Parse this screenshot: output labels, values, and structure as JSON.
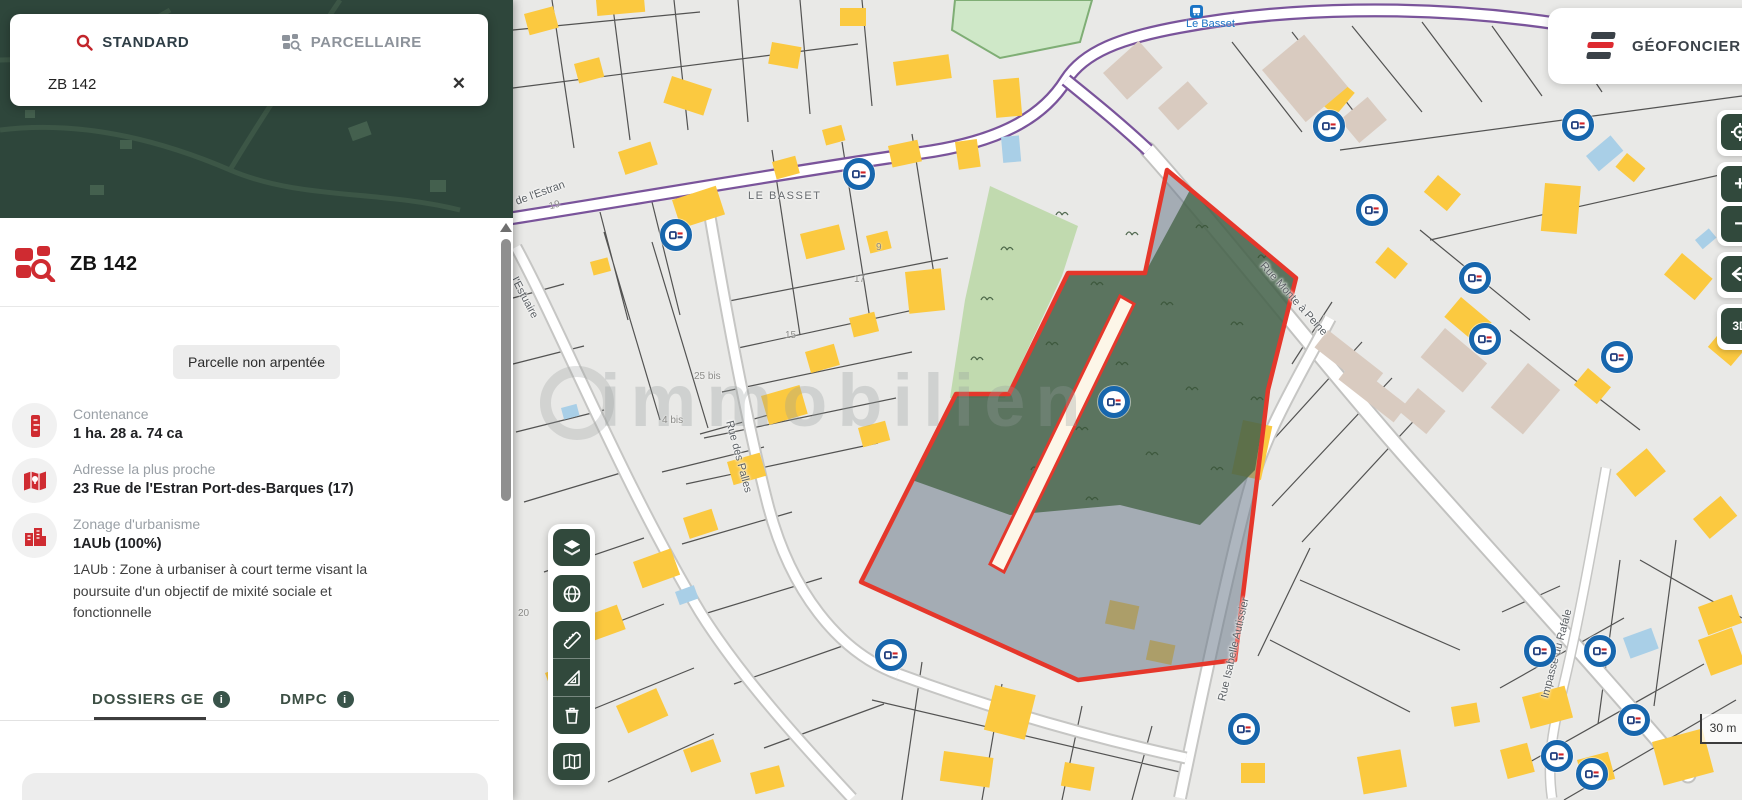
{
  "sidebar": {
    "search": {
      "tabs": [
        {
          "label": "STANDARD",
          "icon": "search-icon",
          "active": true
        },
        {
          "label": "PARCELLAIRE",
          "icon": "parcel-search-icon",
          "active": false
        }
      ],
      "value": "ZB 142",
      "clear": "✕"
    },
    "parcel": {
      "id": "ZB 142",
      "badge": "Parcelle non arpentée",
      "fields": [
        {
          "icon": "ruler-icon",
          "label": "Contenance",
          "value": "1 ha. 28 a. 74 ca"
        },
        {
          "icon": "map-pin-icon",
          "label": "Adresse la plus proche",
          "value": "23 Rue de l'Estran Port-des-Barques (17)"
        },
        {
          "icon": "buildings-icon",
          "label": "Zonage d'urbanisme",
          "value": "1AUb (100%)",
          "description": "1AUb : Zone à urbaniser à court terme visant la poursuite d'un objectif de mixité sociale et fonctionnelle"
        }
      ],
      "tabs": [
        {
          "label": "DOSSIERS GE",
          "info": "i",
          "active": true
        },
        {
          "label": "DMPC",
          "info": "i",
          "active": false
        }
      ]
    }
  },
  "map": {
    "brand": "GÉOFONCIER",
    "scale_label": "30 m",
    "watermark": "immobilien",
    "place_label": "LE BASSET",
    "bus_stop": "Le Basset",
    "streets": [
      "de l'Estran",
      "Rue des Palles",
      "Rue Monte à Peine",
      "Rue Isabelle Autissier",
      "Impasse du Rafale",
      "l'Estuaire"
    ],
    "parcel_numbers": [
      "19",
      "9",
      "17",
      "15",
      "25 bis",
      "4 bis",
      "20"
    ],
    "markers": [
      [
        859,
        174
      ],
      [
        676,
        235
      ],
      [
        1329,
        126
      ],
      [
        1372,
        210
      ],
      [
        1578,
        125
      ],
      [
        1475,
        278
      ],
      [
        1485,
        339
      ],
      [
        1617,
        357
      ],
      [
        1114,
        402
      ],
      [
        891,
        655
      ],
      [
        1244,
        729
      ],
      [
        1540,
        651
      ],
      [
        1600,
        651
      ],
      [
        1634,
        720
      ],
      [
        1557,
        756
      ],
      [
        1592,
        774
      ]
    ],
    "tools": [
      "layers-icon",
      "globe-icon",
      "ruler-icon",
      "set-square-icon",
      "trash-icon",
      "map-book-icon"
    ],
    "zoom_controls": [
      "locate",
      "zoom-in",
      "zoom-out",
      "back",
      "3d"
    ],
    "colors": {
      "selection_red": "#e5372b",
      "woodland_green": "#54724f",
      "zone_gray": "#76839a",
      "building_yellow": "#fbc940",
      "brand_green": "#31493c",
      "brand_red": "#d7282f",
      "marker_blue": "#1766ad",
      "route_purple": "#7a549b"
    }
  }
}
